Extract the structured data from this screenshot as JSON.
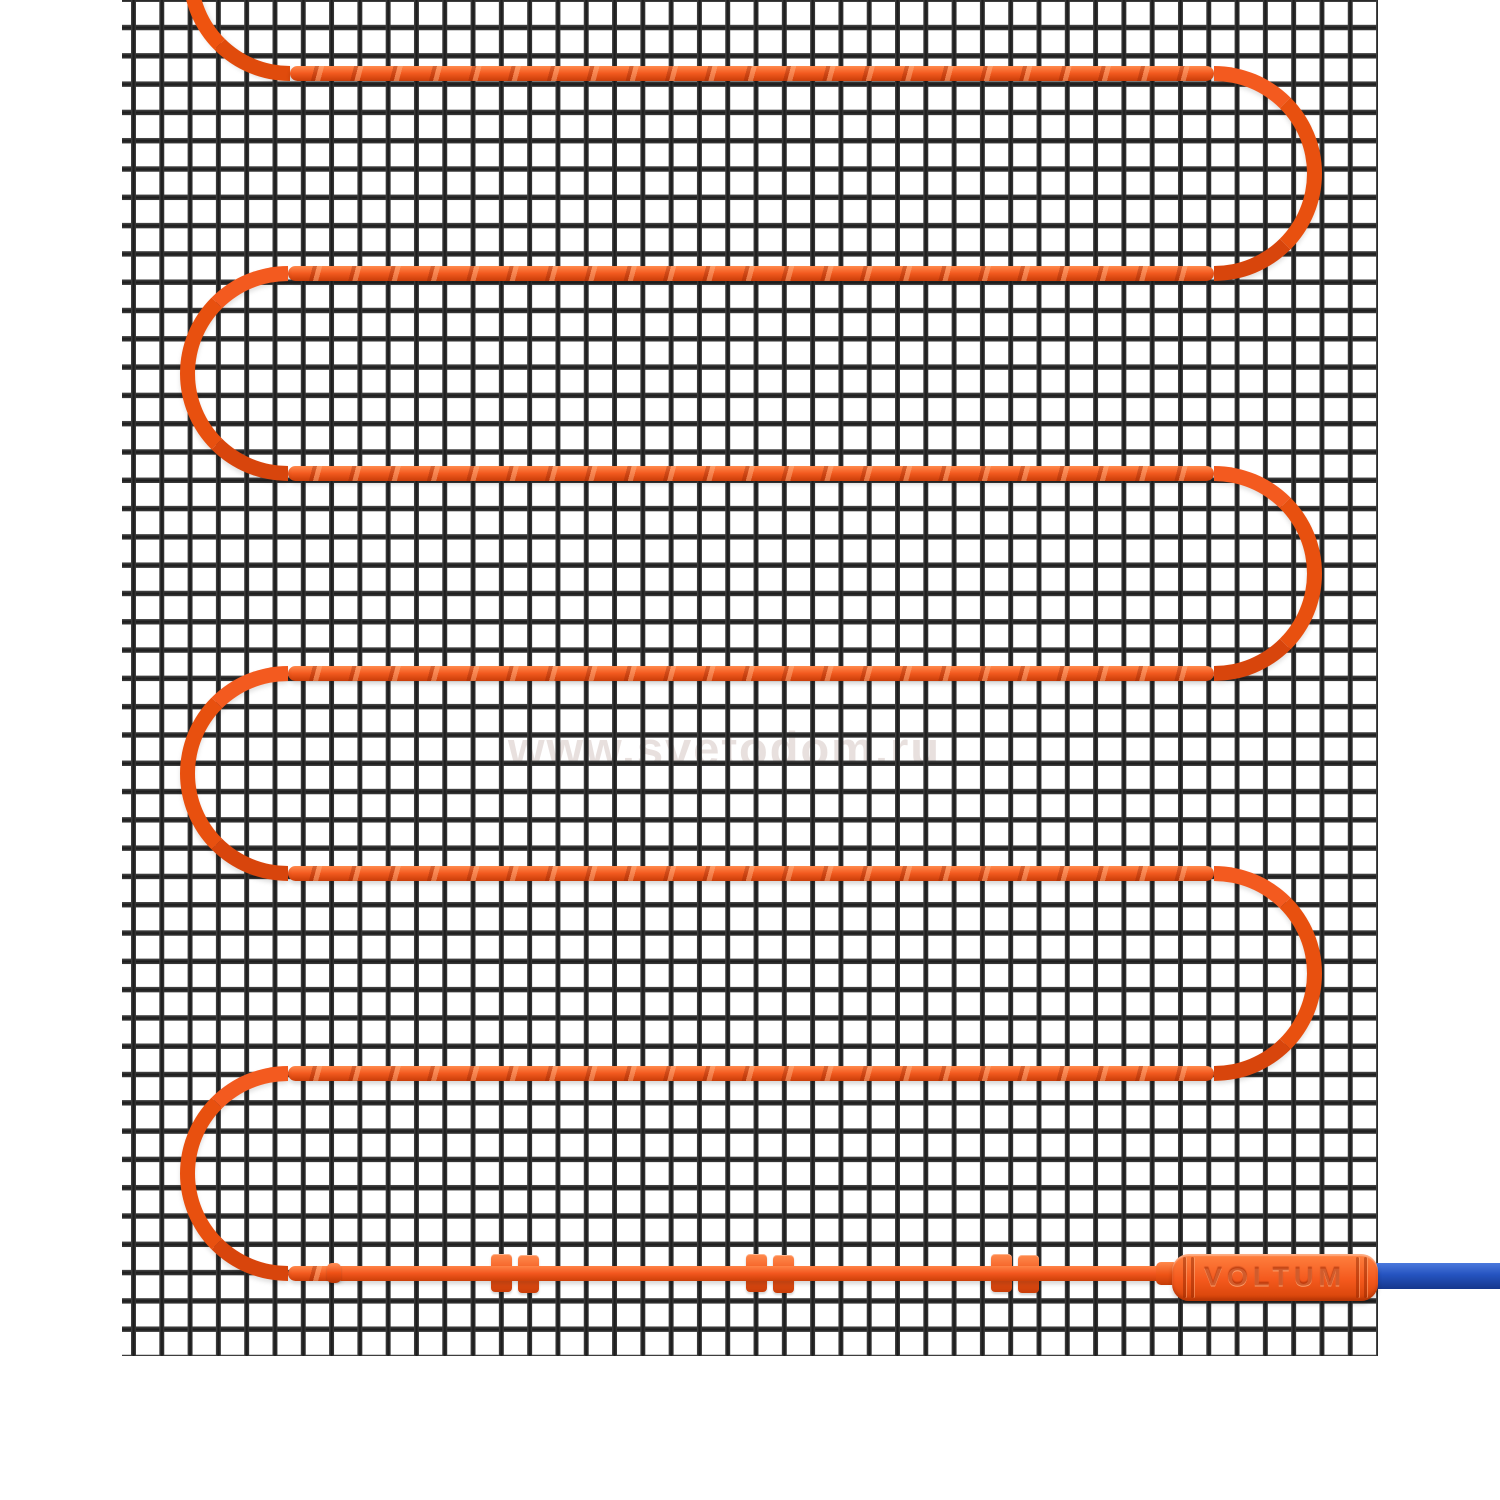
{
  "watermark": {
    "text": "www.svetodom.ru"
  },
  "connector": {
    "brand_label": "VOLTUM"
  },
  "mat": {
    "type": "electric-underfloor-heating-mat",
    "heating_cable_runs": 7,
    "left_u_turns": 3,
    "right_u_turns": 3,
    "splice_clips": 3
  },
  "theme": {
    "cable-orange": "#F1551F",
    "cable-orange-light": "#FF8A4A",
    "cable-orange-dark": "#C93D08",
    "mesh-wire": "#2E2E2E",
    "lead-blue": "#2553BE",
    "lead-blue-dark": "#16378C",
    "watermark-gray": "#E8E0DE",
    "background": "#FFFFFF"
  }
}
